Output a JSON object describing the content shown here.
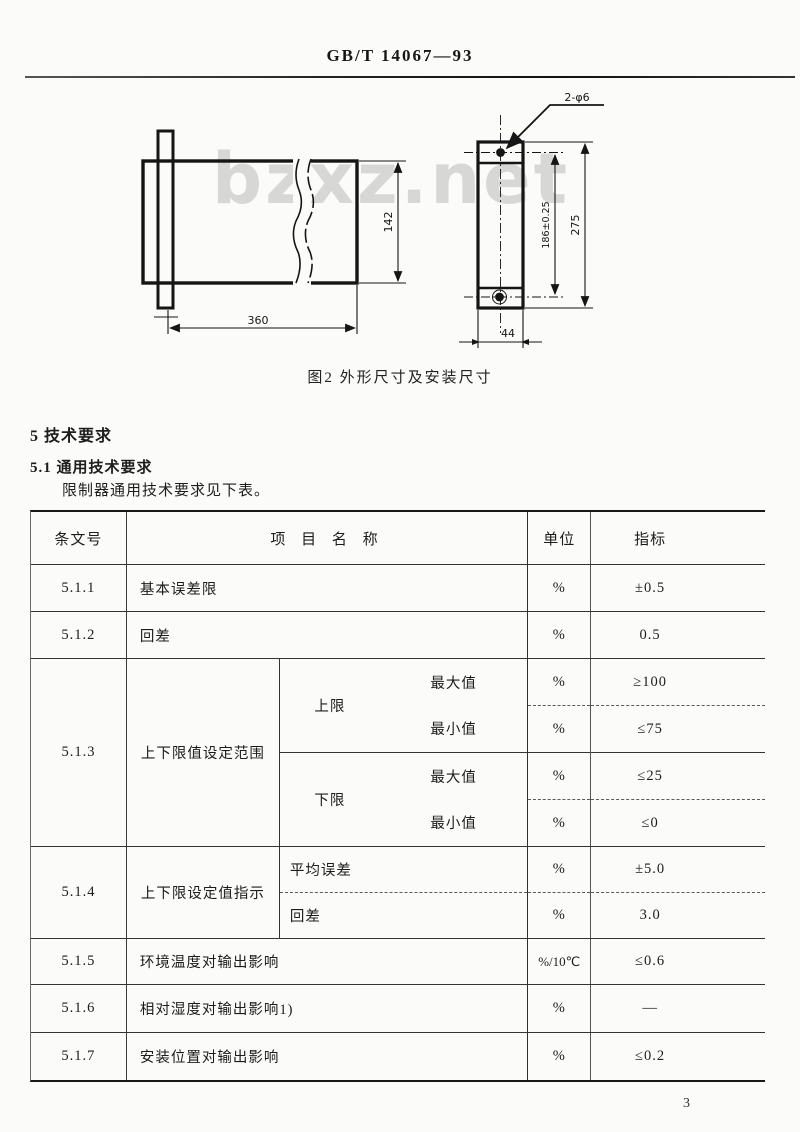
{
  "page": {
    "header": "GB/T 14067—93",
    "page_number": "3",
    "watermark": "bzxz.net"
  },
  "figure": {
    "caption": "图2  外形尺寸及安装尺寸",
    "dims": {
      "body_length": "360",
      "body_height": "142",
      "hole_note": "2-φ6",
      "hole_spacing": "186±0.25",
      "overall_height": "275",
      "mount_width": "44"
    }
  },
  "sections": {
    "s5": "5  技术要求",
    "s51": "5.1  通用技术要求",
    "s51_intro": "限制器通用技术要求见下表。"
  },
  "table": {
    "h_clause": "条文号",
    "h_item": "项 目 名 称",
    "h_unit": "单位",
    "h_index": "指标",
    "r511": {
      "no": "5.1.1",
      "item": "基本误差限",
      "unit": "%",
      "value": "±0.5"
    },
    "r512": {
      "no": "5.1.2",
      "item": "回差",
      "unit": "%",
      "value": "0.5"
    },
    "r513": {
      "no": "5.1.3",
      "item": "上下限值设定范围",
      "upper": {
        "label": "上限",
        "max": {
          "label": "最大值",
          "unit": "%",
          "value": "≥100"
        },
        "min": {
          "label": "最小值",
          "unit": "%",
          "value": "≤75"
        }
      },
      "lower": {
        "label": "下限",
        "max": {
          "label": "最大值",
          "unit": "%",
          "value": "≤25"
        },
        "min": {
          "label": "最小值",
          "unit": "%",
          "value": "≤0"
        }
      }
    },
    "r514": {
      "no": "5.1.4",
      "item": "上下限设定值指示",
      "avg": {
        "label": "平均误差",
        "unit": "%",
        "value": "±5.0"
      },
      "hys": {
        "label": "回差",
        "unit": "%",
        "value": "3.0"
      }
    },
    "r515": {
      "no": "5.1.5",
      "item": "环境温度对输出影响",
      "unit": "%/10℃",
      "value": "≤0.6"
    },
    "r516": {
      "no": "5.1.6",
      "item": "相对湿度对输出影响1)",
      "unit": "%",
      "value": "—"
    },
    "r517": {
      "no": "5.1.7",
      "item": "安装位置对输出影响",
      "unit": "%",
      "value": "≤0.2"
    }
  }
}
